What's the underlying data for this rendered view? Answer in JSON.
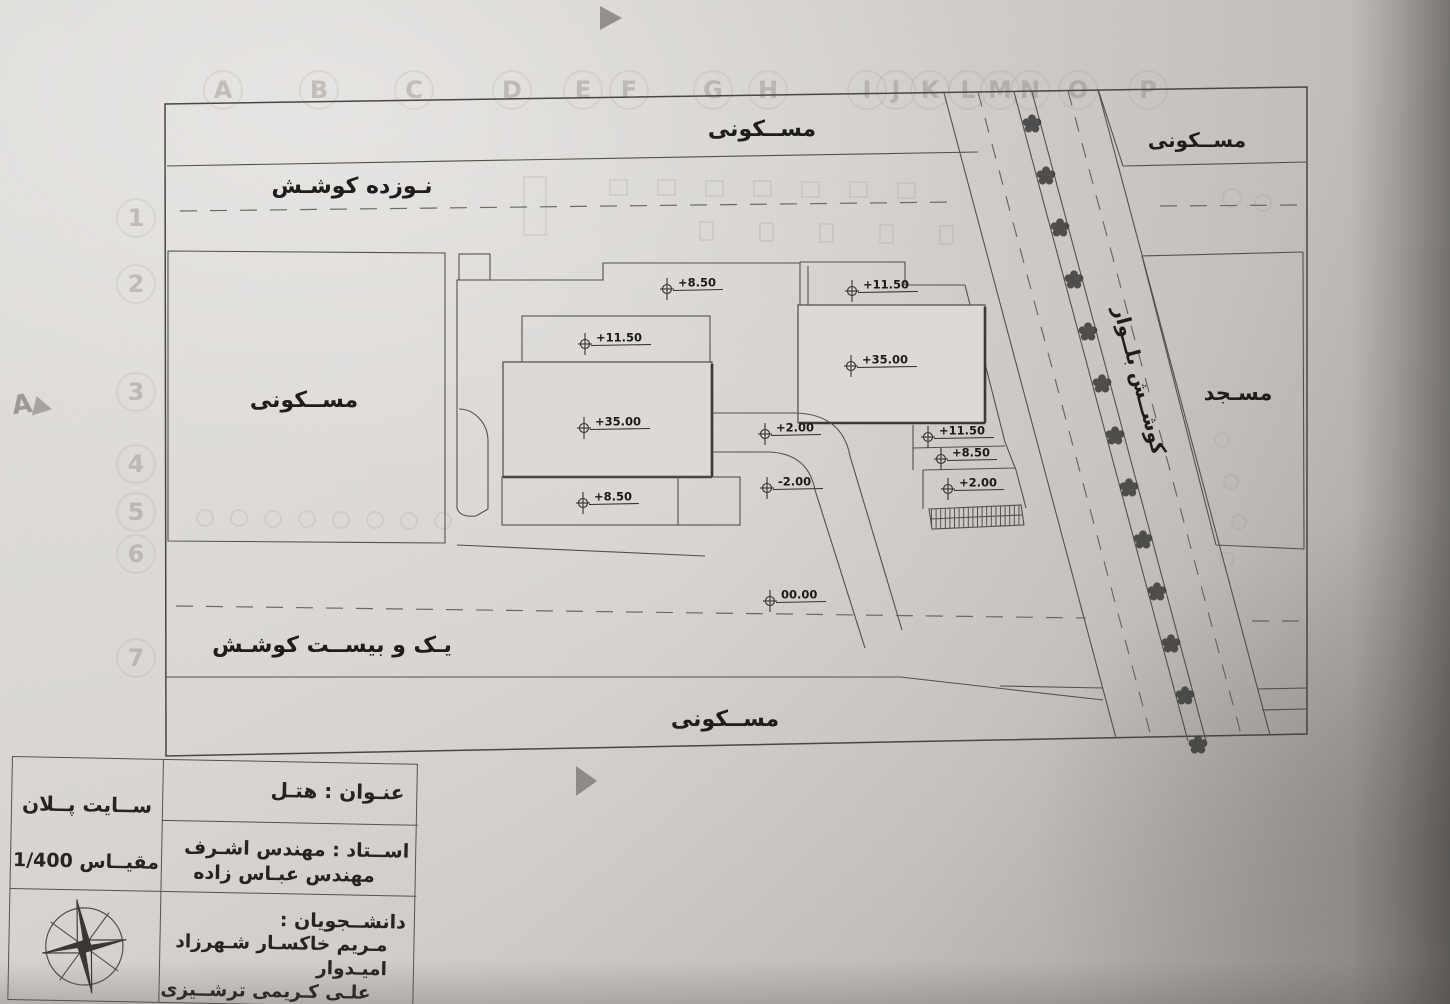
{
  "grid": {
    "letters": [
      {
        "t": "A",
        "x": 223
      },
      {
        "t": "B",
        "x": 319
      },
      {
        "t": "C",
        "x": 414
      },
      {
        "t": "D",
        "x": 512
      },
      {
        "t": "E",
        "x": 583
      },
      {
        "t": "F",
        "x": 629
      },
      {
        "t": "G",
        "x": 713
      },
      {
        "t": "H",
        "x": 768
      },
      {
        "t": "I",
        "x": 867
      },
      {
        "t": "J",
        "x": 896
      },
      {
        "t": "K",
        "x": 930
      },
      {
        "t": "L",
        "x": 968
      },
      {
        "t": "M",
        "x": 1000
      },
      {
        "t": "N",
        "x": 1030
      },
      {
        "t": "O",
        "x": 1078
      },
      {
        "t": "P",
        "x": 1148
      }
    ],
    "numbers": [
      {
        "t": "1",
        "y": 200
      },
      {
        "t": "2",
        "y": 266
      },
      {
        "t": "3",
        "y": 374
      },
      {
        "t": "4",
        "y": 446
      },
      {
        "t": "5",
        "y": 494
      },
      {
        "t": "6",
        "y": 536
      },
      {
        "t": "7",
        "y": 640
      }
    ],
    "side_mark": "A"
  },
  "plan": {
    "area_labels": [
      {
        "id": "residential-top",
        "text": "مســکونی",
        "x": 762,
        "y": 136,
        "size": 22
      },
      {
        "id": "residential-top-right",
        "text": "مســکونی",
        "x": 1197,
        "y": 147,
        "size": 20
      },
      {
        "id": "residential-left",
        "text": "مســکونی",
        "x": 304,
        "y": 407,
        "size": 22
      },
      {
        "id": "residential-bottom",
        "text": "مســکونی",
        "x": 725,
        "y": 726,
        "size": 22
      },
      {
        "id": "mosque",
        "text": "مسـجد",
        "x": 1238,
        "y": 400,
        "size": 21
      },
      {
        "id": "street-top",
        "text": "نـوزده کوشـش",
        "x": 352,
        "y": 193,
        "size": 22
      },
      {
        "id": "street-bottom",
        "text": "یـک و بیســت کوشـش",
        "x": 332,
        "y": 652,
        "size": 22
      },
      {
        "id": "boulevard",
        "text": "کوشــش بلــوار",
        "x": 1133,
        "y": 382,
        "size": 20,
        "rotate": 75
      }
    ],
    "elevations": [
      {
        "v": "+8.50",
        "x": 667,
        "y": 289
      },
      {
        "v": "+11.50",
        "x": 852,
        "y": 291
      },
      {
        "v": "+11.50",
        "x": 585,
        "y": 344
      },
      {
        "v": "+35.00",
        "x": 851,
        "y": 366
      },
      {
        "v": "+35.00",
        "x": 584,
        "y": 428
      },
      {
        "v": "+2.00",
        "x": 765,
        "y": 434
      },
      {
        "v": "+11.50",
        "x": 928,
        "y": 437
      },
      {
        "v": "+8.50",
        "x": 941,
        "y": 459
      },
      {
        "v": "-2.00",
        "x": 767,
        "y": 488
      },
      {
        "v": "+2.00",
        "x": 948,
        "y": 489
      },
      {
        "v": "+8.50",
        "x": 583,
        "y": 503
      },
      {
        "v": "00.00",
        "x": 770,
        "y": 601
      }
    ],
    "trees": [
      [
        1032,
        124
      ],
      [
        1046,
        176
      ],
      [
        1060,
        228
      ],
      [
        1074,
        280
      ],
      [
        1088,
        332
      ],
      [
        1102,
        384
      ],
      [
        1115,
        436
      ],
      [
        1129,
        488
      ],
      [
        1143,
        540
      ],
      [
        1157,
        592
      ],
      [
        1171,
        644
      ],
      [
        1185,
        696
      ],
      [
        1198,
        745
      ]
    ]
  },
  "titleblock": {
    "sheet_title": "ســایت پــلان",
    "scale": "مقیــاس 1/400",
    "project_title": "عنـوان : هتـل",
    "professor_line1": "اســتاد : مهندس اشـرف",
    "professor_line2": "مهندس عبـاس زاده",
    "students_label": "دانشــجویان :",
    "students_line1": "مـریم خاکسـار    شـهرزاد امیـدوار",
    "students_line2": "علـی کـریمی ترشــیزی",
    "compass_icon": "north-compass",
    "line_color": "#55524e",
    "text_color": "#262320"
  }
}
